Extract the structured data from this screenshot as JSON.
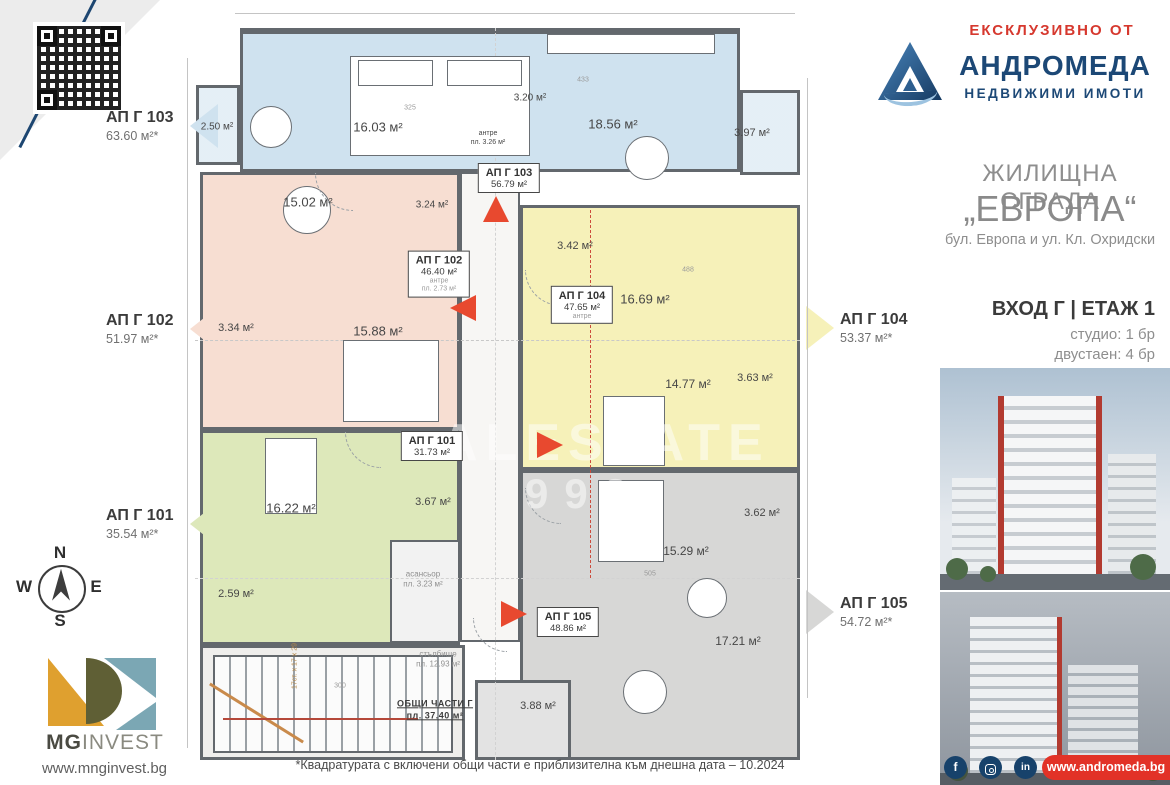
{
  "header": {
    "exclusive_label": "ЕКСКЛУЗИВНО ОТ",
    "agency_name": "АНДРОМЕДА",
    "agency_tagline": "НЕДВИЖИМИ ИМОТИ"
  },
  "project": {
    "building_type": "ЖИЛИЩНА СГРАДА",
    "building_name": "„ЕВРОПА“",
    "address": "бул. Европа и ул. Кл. Охридски",
    "entrance_floor": "ВХОД Г | ЕТАЖ 1",
    "unit_mix": [
      "студио: 1 бр",
      "двустаен: 4 бр"
    ]
  },
  "callouts": [
    {
      "id": "АП Г 103",
      "area": "63.60 м²*",
      "side": "left",
      "color": "#cfe2ef"
    },
    {
      "id": "АП Г 102",
      "area": "51.97 м²*",
      "side": "left",
      "color": "#f7ded2"
    },
    {
      "id": "АП Г 101",
      "area": "35.54 м²*",
      "side": "left",
      "color": "#dde8ba"
    },
    {
      "id": "АП Г 104",
      "area": "53.37 м²*",
      "side": "right",
      "color": "#f6f1b9"
    },
    {
      "id": "АП Г 105",
      "area": "54.72 м²*",
      "side": "right",
      "color": "#d7d7d6"
    }
  ],
  "plan": {
    "unit_boxes": [
      {
        "id": "u103",
        "title": "АП Г 103",
        "area": "56.79 м²",
        "extras": []
      },
      {
        "id": "u102",
        "title": "АП Г 102",
        "area": "46.40 м²",
        "extras": [
          "антре",
          "пл. 2.73 м²"
        ]
      },
      {
        "id": "u104",
        "title": "АП Г 104",
        "area": "47.65 м²",
        "extras": [
          "антре"
        ]
      },
      {
        "id": "u101",
        "title": "АП Г 101",
        "area": "31.73 м²",
        "extras": []
      },
      {
        "id": "u105",
        "title": "АП Г 105",
        "area": "48.86 м²",
        "extras": []
      }
    ],
    "rooms": [
      {
        "id": "r103-balcony-left",
        "lines": [
          "2.50 м²"
        ]
      },
      {
        "id": "r103-bedroom",
        "lines": [
          "16.03 м²"
        ]
      },
      {
        "id": "r103-bath",
        "lines": [
          "3.20 м²"
        ]
      },
      {
        "id": "r103-living",
        "lines": [
          "18.56 м²"
        ]
      },
      {
        "id": "r103-balcony-right",
        "lines": [
          "3.97 м²"
        ]
      },
      {
        "id": "r103-antre",
        "lines": [
          "антре",
          "пл. 3.26 м²"
        ]
      },
      {
        "id": "r102-living",
        "lines": [
          "15.02 м²"
        ]
      },
      {
        "id": "r102-bath",
        "lines": [
          "3.24 м²"
        ]
      },
      {
        "id": "r102-entry",
        "lines": [
          "3.34 м²"
        ]
      },
      {
        "id": "r102-bedroom",
        "lines": [
          "15.88 м²"
        ]
      },
      {
        "id": "r104-bath",
        "lines": [
          "3.42 м²"
        ]
      },
      {
        "id": "r104-living",
        "lines": [
          "16.69 м²"
        ]
      },
      {
        "id": "r104-bedroom",
        "lines": [
          "14.77 м²"
        ]
      },
      {
        "id": "r104-balcony",
        "lines": [
          "3.63 м²"
        ]
      },
      {
        "id": "r101-room",
        "lines": [
          "16.22 м²"
        ]
      },
      {
        "id": "r101-bath",
        "lines": [
          "3.67 м²"
        ]
      },
      {
        "id": "r101-balcony",
        "lines": [
          "2.59 м²"
        ]
      },
      {
        "id": "r105-bedroom",
        "lines": [
          "15.29 м²"
        ]
      },
      {
        "id": "r105-balcony",
        "lines": [
          "3.62 м²"
        ]
      },
      {
        "id": "r105-living",
        "lines": [
          "17.21 м²"
        ]
      },
      {
        "id": "r105-bath",
        "lines": [
          "3.88 м²"
        ]
      },
      {
        "id": "elevator",
        "lines": [
          "асансьор",
          "пл. 3.23 м²"
        ]
      },
      {
        "id": "stairs",
        "lines": [
          "стълбище",
          "пл. 12.93 м²"
        ]
      },
      {
        "id": "common",
        "lines": [
          "ОБЩИ ЧАСТИ Г",
          "пл.  37.40 м²"
        ]
      },
      {
        "id": "stair-note",
        "lines": [
          "17ст. х 17 х 29"
        ]
      }
    ],
    "dims": [
      "433",
      "488",
      "505",
      "325",
      "300"
    ],
    "watermark": [
      "ALESTATE",
      "993"
    ]
  },
  "compass": {
    "north": "N",
    "east": "E",
    "south": "S",
    "west": "W"
  },
  "developer": {
    "name_bold": "MG",
    "name_light": "INVEST",
    "website": "www.mnginvest.bg"
  },
  "agency_footer": {
    "website": "www.andromeda.bg",
    "social": [
      {
        "name": "facebook",
        "glyph": "f"
      },
      {
        "name": "instagram",
        "glyph": ""
      },
      {
        "name": "linkedin",
        "glyph": "in"
      }
    ]
  },
  "disclaimer": "*Квадратурата с включени общи части е приблизителна към днешна дата – 10.2024"
}
